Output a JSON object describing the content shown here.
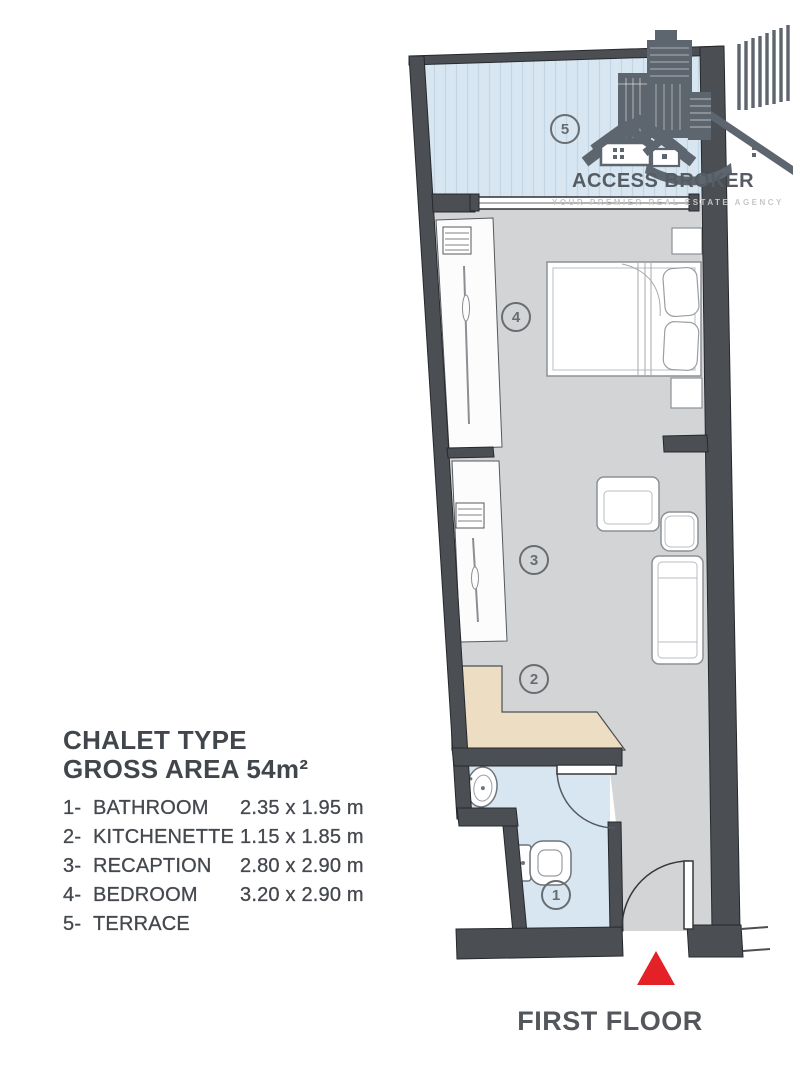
{
  "logo": {
    "name": "ACCESS BROKER",
    "tagline": "YOUR PREMIER REAL ESTATE AGENCY"
  },
  "legend": {
    "title": "CHALET TYPE",
    "subtitle": "GROSS AREA 54m²",
    "rooms": [
      {
        "num": "1-",
        "name": "BATHROOM",
        "dims": "2.35 x 1.95 m"
      },
      {
        "num": "2-",
        "name": "KITCHENETTE",
        "dims": "1.15 x 1.85 m"
      },
      {
        "num": "3-",
        "name": "RECAPTION",
        "dims": "2.80 x 2.90 m"
      },
      {
        "num": "4-",
        "name": "BEDROOM",
        "dims": "3.20 x 2.90 m"
      },
      {
        "num": "5-",
        "name": "TERRACE",
        "dims": ""
      }
    ]
  },
  "plan": {
    "markers": {
      "terrace": "5",
      "bedroom": "4",
      "reception": "3",
      "kitchenette": "2",
      "bathroom": "1"
    }
  },
  "footer": {
    "label": "FIRST FLOOR"
  },
  "colors": {
    "wall": "#4b4f54",
    "floor": "#d3d4d6",
    "wet": "#d8e6f2",
    "stripe": "#c3d6e6",
    "counter": "#ecddc3",
    "accent": "#e32127",
    "logo": "#5d656e",
    "marker": "#686d72",
    "text": "#45494f",
    "tagline": "#c6c6c6"
  }
}
